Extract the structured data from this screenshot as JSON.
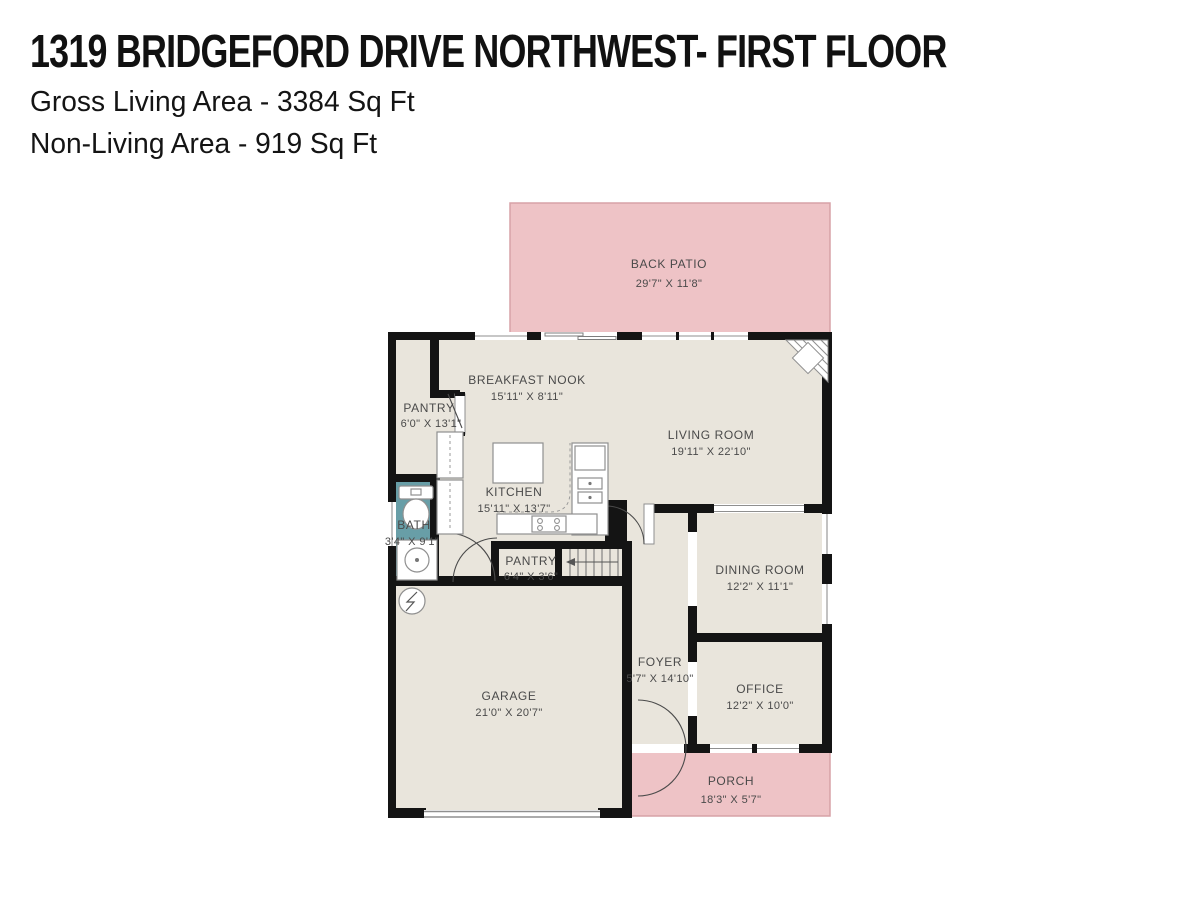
{
  "header": {
    "title": "1319 BRIDGEFORD DRIVE NORTHWEST- FIRST FLOOR",
    "gross_living_area": "Gross Living Area - 3384 Sq Ft",
    "non_living_area": "Non-Living Area - 919 Sq Ft"
  },
  "rooms": {
    "back_patio": {
      "label": "BACK PATIO",
      "dims": "29'7\" X 11'8\""
    },
    "breakfast_nook": {
      "label": "BREAKFAST NOOK",
      "dims": "15'11\" X 8'11\""
    },
    "pantry_upper": {
      "label": "PANTRY",
      "dims": "6'0\" X 13'1\""
    },
    "living_room": {
      "label": "LIVING ROOM",
      "dims": "19'11\" X 22'10\""
    },
    "kitchen": {
      "label": "KITCHEN",
      "dims": "15'11\" X 13'7\""
    },
    "bath": {
      "label": "BATH",
      "dims": "3'4\" X 9'1\""
    },
    "pantry_lower": {
      "label": "PANTRY",
      "dims": "6'4\" X 3'6\""
    },
    "dining_room": {
      "label": "DINING ROOM",
      "dims": "12'2\" X 11'1\""
    },
    "garage": {
      "label": "GARAGE",
      "dims": "21'0\" X 20'7\""
    },
    "foyer": {
      "label": "FOYER",
      "dims": "5'7\" X 14'10\""
    },
    "office": {
      "label": "OFFICE",
      "dims": "12'2\" X 10'0\""
    },
    "porch": {
      "label": "PORCH",
      "dims": "18'3\" X 5'7\""
    }
  },
  "colors": {
    "wall": "#141414",
    "floor": "#e9e5dc",
    "outdoor": "#eec3c6",
    "outdoor_border": "#d7a2a7",
    "bath": "#689ea7",
    "fixture_outline": "#8f8f8f",
    "label_text": "#4a4a4a"
  }
}
